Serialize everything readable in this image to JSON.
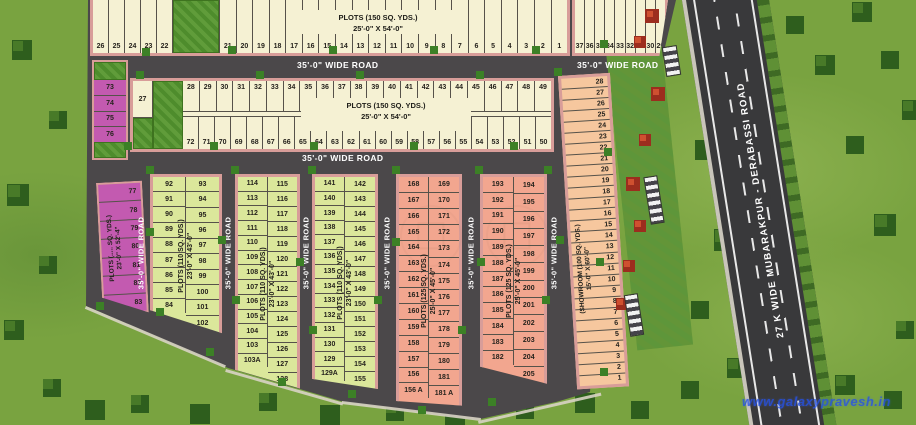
{
  "labels": {
    "wide_road": "35'-0\" WIDE ROAD",
    "highway": "27 K WIDE MUBARAKPUR - DERABASSI ROAD",
    "plots150_l1": "PLOTS (150 SQ. YDS.)",
    "plots150_l2": "25'-0\" X 54'-0\"",
    "plots110_l1": "PLOTS (110 SQ. YDS.)",
    "plots110_l2": "23'-0\" X 43'-0\"",
    "plots125_l1": "PLOTS (125 SQ. YDS.)",
    "plots125_l2": "25'-0\" X 45'-0\"",
    "purple_l1": "PLOTS (..... SQ. YDS.)",
    "purple_l2": "23'-0\" X 52'-4\"",
    "showroom_l1": "(SHOWROOM (100 SQ. YDS.)",
    "showroom_l2": "15'-0\" X 60'-0\""
  },
  "top_row": {
    "left": [
      "26",
      "25",
      "24",
      "23",
      "22"
    ],
    "right": [
      "21",
      "20",
      "19",
      "18",
      "17",
      "16",
      "15",
      "14",
      "13",
      "12",
      "11",
      "10",
      "9",
      "8",
      "7",
      "6",
      "5",
      "4",
      "3",
      "2",
      "1"
    ],
    "corner": [
      "37",
      "36",
      "35",
      "34",
      "33",
      "32",
      "31",
      "30",
      "29"
    ]
  },
  "row2": {
    "single": "27",
    "top": [
      "28",
      "29",
      "30",
      "31",
      "32",
      "33",
      "34",
      "35",
      "36",
      "37",
      "38",
      "39",
      "40",
      "41",
      "42",
      "43",
      "44",
      "45",
      "46",
      "47",
      "48",
      "49"
    ],
    "bottom": [
      "72",
      "71",
      "70",
      "69",
      "68",
      "67",
      "66",
      "65",
      "64",
      "63",
      "62",
      "61",
      "60",
      "59",
      "58",
      "57",
      "56",
      "55",
      "54",
      "53",
      "52",
      "51",
      "50"
    ]
  },
  "purple_top": [
    "73",
    "74",
    "75",
    "76"
  ],
  "purple_col": [
    "77",
    "78",
    "79",
    "80",
    "81",
    "82",
    "83"
  ],
  "col1": {
    "left": [
      "92",
      "91",
      "90",
      "89",
      "88",
      "87",
      "86",
      "85",
      "84"
    ],
    "right": [
      "93",
      "94",
      "95",
      "96",
      "97",
      "98",
      "99",
      "100",
      "101",
      "102"
    ]
  },
  "col2": {
    "left": [
      "114",
      "113",
      "112",
      "111",
      "110",
      "109",
      "108",
      "107",
      "106",
      "105",
      "104",
      "103",
      "103A"
    ],
    "right": [
      "115",
      "116",
      "117",
      "118",
      "119",
      "120",
      "121",
      "122",
      "123",
      "124",
      "125",
      "126",
      "127",
      "128"
    ]
  },
  "col3": {
    "left": [
      "141",
      "140",
      "139",
      "138",
      "137",
      "136",
      "135",
      "134",
      "133",
      "132",
      "131",
      "130",
      "129",
      "129A"
    ],
    "right": [
      "142",
      "143",
      "144",
      "145",
      "146",
      "147",
      "148",
      "149",
      "150",
      "151",
      "152",
      "153",
      "154",
      "155"
    ]
  },
  "col4": {
    "left": [
      "168",
      "167",
      "166",
      "165",
      "164",
      "163",
      "162",
      "161",
      "160",
      "159",
      "158",
      "157",
      "156",
      "156 A"
    ],
    "right": [
      "169",
      "170",
      "171",
      "172",
      "173",
      "174",
      "175",
      "176",
      "177",
      "178",
      "179",
      "180",
      "181",
      "181 A"
    ]
  },
  "col5": {
    "left": [
      "193",
      "192",
      "191",
      "190",
      "189",
      "188",
      "187",
      "186",
      "185",
      "184",
      "183",
      "182"
    ],
    "right": [
      "194",
      "195",
      "196",
      "197",
      "198",
      "199",
      "200",
      "201",
      "202",
      "203",
      "204",
      "205"
    ]
  },
  "showroom": [
    "28",
    "27",
    "26",
    "25",
    "24",
    "23",
    "22",
    "21",
    "20",
    "19",
    "18",
    "17",
    "16",
    "15",
    "14",
    "13",
    "12",
    "11",
    "10",
    "9",
    "8",
    "7",
    "6",
    "5",
    "4",
    "3",
    "2",
    "1"
  ],
  "watermark": "www.galaxypravesh.in",
  "colors": {
    "plot_cream": "#f5f1d3",
    "plot_green": "#dbe79b",
    "plot_salmon": "#f2a68f",
    "plot_purple": "#c35ab0",
    "showroom_peach": "#f6c79e",
    "road": "#4b484a",
    "curb_pink": "#d89d99",
    "grass": "#79a340",
    "highway": "#39393b",
    "watermark_blue": "#2653e8"
  }
}
